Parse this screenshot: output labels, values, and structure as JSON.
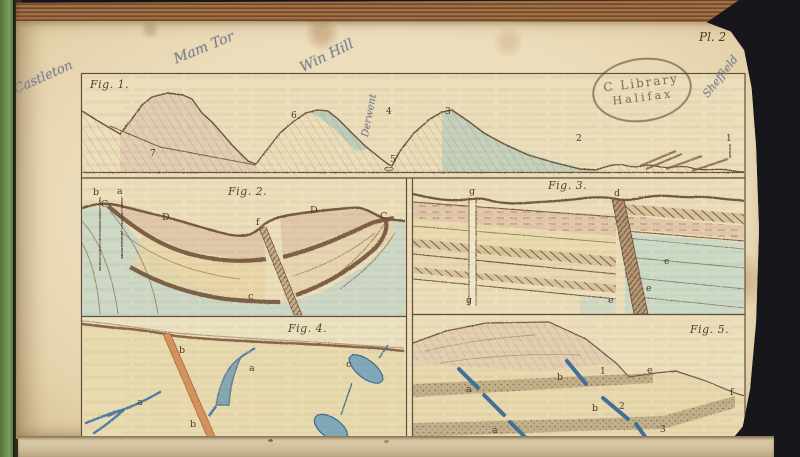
{
  "plate_label": "Pl. 2",
  "stamp": {
    "line1": "C Library",
    "line2": "Halifax"
  },
  "annotations": {
    "castleton": "Castleton",
    "mam_tor": "Mam Tor",
    "win_hill": "Win Hill",
    "derwent": "Derwent",
    "sheffield": "Sheffield"
  },
  "figures": {
    "fig1": {
      "title": "Fig. 1.",
      "numbers": {
        "n1": "1",
        "n2": "2",
        "n3": "3",
        "n4": "4",
        "n5": "5",
        "n6": "6",
        "n7": "7"
      }
    },
    "fig2": {
      "title": "Fig. 2.",
      "letters": {
        "b": "b",
        "a": "a",
        "c_left": "C",
        "d_left": "D",
        "f": "f",
        "d_right": "D",
        "c_right": "C",
        "c_small": "c"
      }
    },
    "fig3": {
      "title": "Fig. 3.",
      "letters": {
        "g_top": "g",
        "g_bottom": "g",
        "d": "d",
        "e1": "e",
        "e2": "e",
        "e3": "e"
      }
    },
    "fig4": {
      "title": "Fig. 4.",
      "letters": {
        "b_top": "b",
        "b_bottom": "b",
        "a_left": "a",
        "a_mid": "a",
        "c": "c"
      }
    },
    "fig5": {
      "title": "Fig. 5.",
      "letters": {
        "a_upper": "a",
        "a_lower": "a",
        "b_upper": "b",
        "b_lower": "b",
        "e": "e",
        "f": "f",
        "n1": "1",
        "n2": "2",
        "n3": "3",
        "n4": "4"
      }
    }
  },
  "colors": {
    "page_cream": "#e8d8b4",
    "spine_green": "#6f9252",
    "top_edge_brown": "#96663e",
    "engraving_line": "#6b523a",
    "wash_green": "#c5d6c6",
    "wash_salmon": "#e2c3a8",
    "wash_buff": "#e9d8a8",
    "dike_orange": "#d6935f",
    "vein_blue": "#4c7da6",
    "stipple_band": "#c3b18d",
    "background": "#17171b"
  }
}
